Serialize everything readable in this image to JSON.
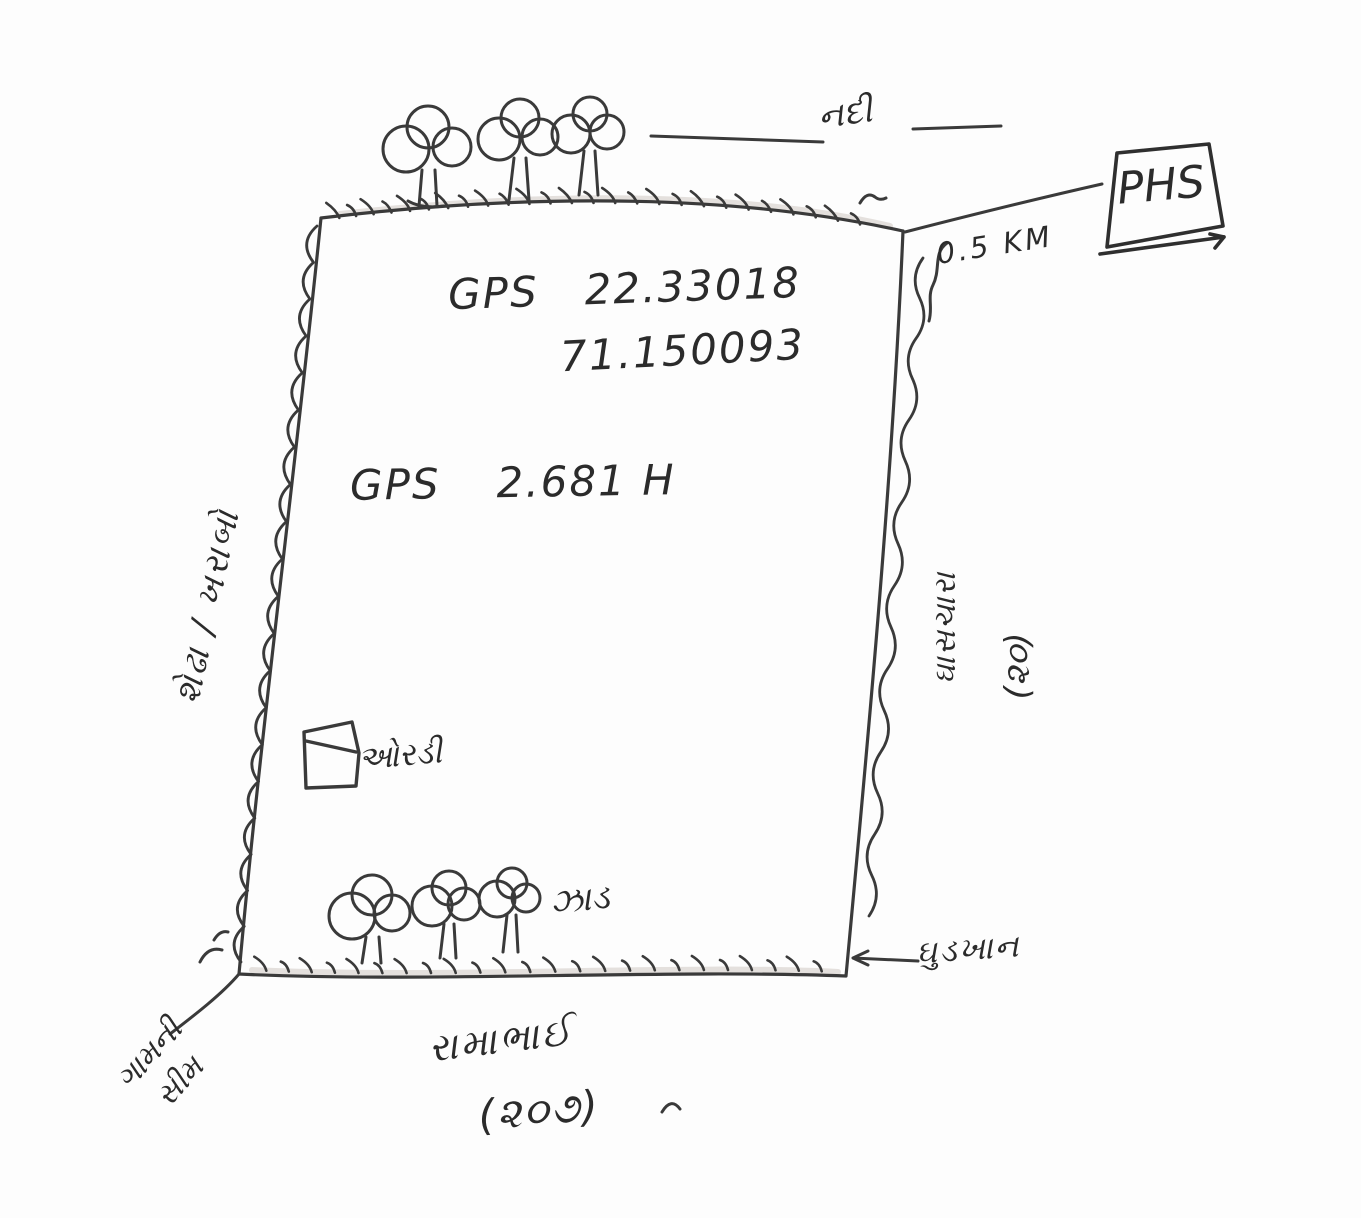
{
  "colors": {
    "ink": "#3a3a3a",
    "paper": "#fdfdfd",
    "shade": "#cfc9c2"
  },
  "plot": {
    "gps_label": "GPS",
    "latitude": "22.33018",
    "longitude": "71.150093",
    "area_label": "GPS",
    "area_value": "2.681 H"
  },
  "surroundings": {
    "river_label": "નદી",
    "phs_label": "PHS",
    "phs_distance": "0.5 KM",
    "left_boundary_label": "શેઢા / ખરાબો",
    "right_neighbor_name": "ઘાસચારા",
    "right_neighbor_survey": "(૨૦)",
    "bottom_neighbor_name": "રામાભાઈ",
    "bottom_neighbor_survey": "(૨૦૭)",
    "bottom_right_label": "ઘુડખાન",
    "hut_label": "ઓરડી",
    "trees_label": "ઝાડ",
    "village_corner_line1": "ગામની",
    "village_corner_line2": "સીમ"
  }
}
